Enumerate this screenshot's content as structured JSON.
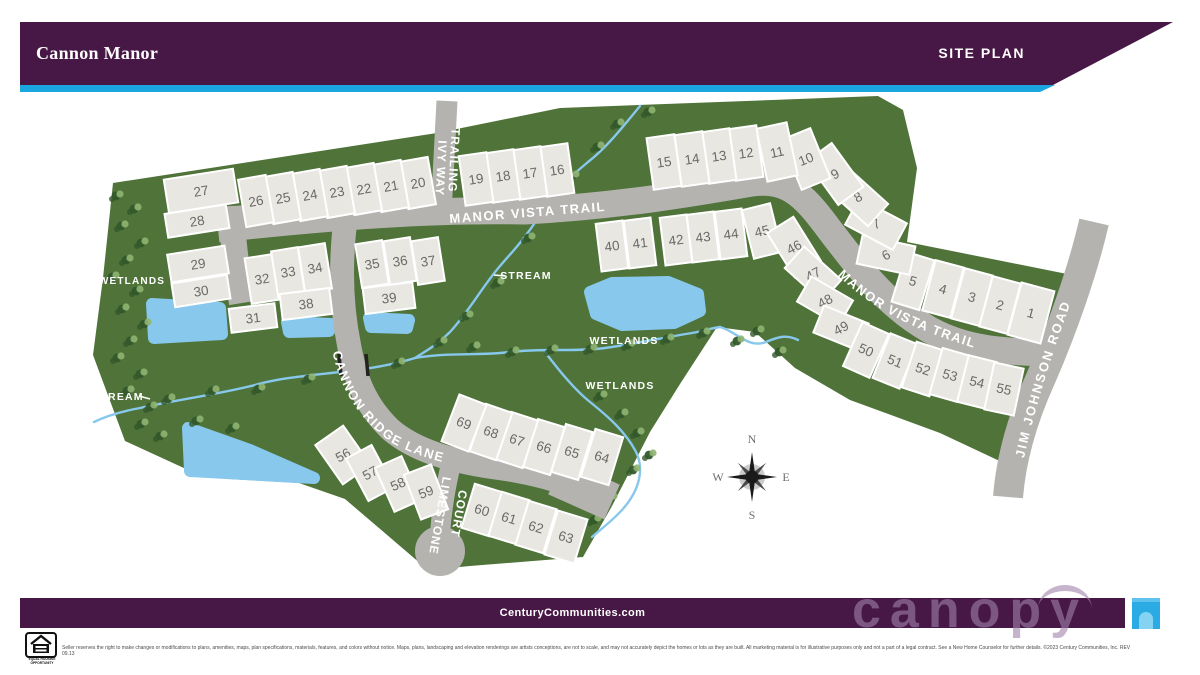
{
  "header": {
    "title": "Cannon Manor",
    "banner_label": "SITE PLAN"
  },
  "colors": {
    "brand_purple": "#471745",
    "accent_cyan": "#1aa7e0",
    "green": "#4f7339",
    "road": "#b5b3b0",
    "lot_fill": "#e9e7e2",
    "lot_stroke": "#ffffff",
    "lot_number": "#6b6a67",
    "water": "#87c8ec",
    "tree_dark": "#33582b",
    "tree_light": "#8fb471",
    "label_white": "#ffffff",
    "compass_dark": "#1a1a1a",
    "compass_gray": "#4a4a4a"
  },
  "map": {
    "site_points": "113,183 437,133 560,108 878,96 903,110 917,168 907,242 1082,277 1046,392 1006,464 940,433 850,400 795,368 755,332 717,327 680,384 650,432 612,506 583,557 470,566 428,570 345,499 299,483 230,479 186,469 125,441 93,355 103,278",
    "roads": [
      {
        "name": "manor-vista-trail",
        "d": "M218,229 C330,217 430,209 525,211 C620,206 700,192 752,183 C790,178 806,198 832,233 C862,272 888,306 930,330 C965,349 1000,352 1052,353",
        "w": 27
      },
      {
        "name": "access-stub",
        "d": "M231,206 C233,245 237,272 242,303",
        "w": 26
      },
      {
        "name": "trailing-ivy-way",
        "d": "M447,101 L441,214",
        "w": 21
      },
      {
        "name": "cannon-ridge-lane",
        "d": "M346,216 C340,260 341,305 349,345 C356,384 368,408 391,430 C416,451 452,461 492,467 C530,472 560,479 606,500",
        "w": 24
      },
      {
        "name": "cannon-ridge-lane-flare",
        "d": "M556,477 L612,502",
        "w": 38
      },
      {
        "name": "limestone-court",
        "d": "M452,460 C446,484 442,506 440,534",
        "w": 20
      },
      {
        "name": "jim-johnson-road",
        "d": "M1094,222 C1083,270 1062,330 1040,380 C1022,420 1011,460 1008,497",
        "w": 30
      }
    ],
    "cul_de_sac": {
      "cx": 440,
      "cy": 551,
      "r": 25
    },
    "culverts": [
      [
        339,
        354,
        341,
        376
      ],
      [
        366,
        354,
        368,
        376
      ]
    ],
    "streams": [
      "M640,106 C622,128 606,148 588,162 C566,180 552,196 540,215 C524,240 512,252 500,266 C482,287 470,310 450,332 C436,346 424,352 415,358",
      "M415,358 C360,375 300,372 255,385 C215,395 175,400 140,408 C118,412 104,417 94,422",
      "M415,358 C450,352 480,356 510,352 C545,348 575,352 605,348 C640,343 666,337 692,333 C704,331 712,328 720,327",
      "M720,327 C736,331 748,349 766,342 C778,337 786,334 798,340",
      "M545,352 C560,372 575,390 590,402 C610,418 625,432 635,450 C645,468 640,490 622,510 C612,521 601,529 592,537"
    ],
    "ponds": [
      {
        "pts": "152,304 220,308 222,334 154,338"
      },
      {
        "pts": "287,322 331,324 329,331 289,332"
      },
      {
        "pts": "369,318 409,320 407,328 371,327"
      },
      {
        "pts": "188,428 250,450 314,478 190,471"
      },
      {
        "pts": "590,292 612,283 668,282 698,294 700,311 674,323 622,325 596,314"
      }
    ],
    "trees": [
      [
        116,
        196
      ],
      [
        134,
        209
      ],
      [
        121,
        226
      ],
      [
        141,
        243
      ],
      [
        126,
        260
      ],
      [
        112,
        277
      ],
      [
        136,
        291
      ],
      [
        122,
        309
      ],
      [
        144,
        324
      ],
      [
        130,
        341
      ],
      [
        117,
        358
      ],
      [
        140,
        374
      ],
      [
        127,
        391
      ],
      [
        150,
        407
      ],
      [
        141,
        424
      ],
      [
        160,
        436
      ],
      [
        648,
        112
      ],
      [
        617,
        124
      ],
      [
        597,
        147
      ],
      [
        572,
        176
      ],
      [
        553,
        204
      ],
      [
        528,
        238
      ],
      [
        497,
        283
      ],
      [
        466,
        316
      ],
      [
        440,
        342
      ],
      [
        398,
        363
      ],
      [
        356,
        371
      ],
      [
        308,
        379
      ],
      [
        258,
        389
      ],
      [
        212,
        391
      ],
      [
        168,
        399
      ],
      [
        232,
        428
      ],
      [
        196,
        421
      ],
      [
        473,
        347
      ],
      [
        512,
        352
      ],
      [
        551,
        350
      ],
      [
        590,
        349
      ],
      [
        628,
        345
      ],
      [
        667,
        339
      ],
      [
        703,
        333
      ],
      [
        737,
        341
      ],
      [
        757,
        331
      ],
      [
        779,
        352
      ],
      [
        600,
        396
      ],
      [
        621,
        414
      ],
      [
        637,
        433
      ],
      [
        649,
        455
      ],
      [
        633,
        470
      ],
      [
        610,
        498
      ],
      [
        594,
        520
      ]
    ],
    "lots": [
      [
        1,
        1031,
        313,
        15,
        34,
        54
      ],
      [
        2,
        1000,
        305,
        15,
        29,
        52
      ],
      [
        3,
        972,
        297,
        15,
        29,
        52
      ],
      [
        4,
        943,
        289,
        15,
        29,
        52
      ],
      [
        5,
        913,
        281,
        17,
        29,
        52
      ],
      [
        6,
        886,
        255,
        -78,
        29,
        54
      ],
      [
        7,
        876,
        224,
        -62,
        30,
        54
      ],
      [
        8,
        858,
        197,
        -48,
        30,
        54
      ],
      [
        9,
        835,
        174,
        -36,
        31,
        54
      ],
      [
        10,
        806,
        159,
        -22,
        31,
        54
      ],
      [
        11,
        777,
        152,
        -12,
        31,
        54
      ],
      [
        12,
        746,
        153,
        -8,
        28,
        52
      ],
      [
        13,
        719,
        156,
        -8,
        28,
        52
      ],
      [
        14,
        692,
        159,
        -8,
        28,
        52
      ],
      [
        15,
        664,
        162,
        -8,
        28,
        52
      ],
      [
        16,
        557,
        170,
        -8,
        28,
        50
      ],
      [
        17,
        530,
        173,
        -8,
        28,
        50
      ],
      [
        18,
        503,
        176,
        -8,
        28,
        50
      ],
      [
        19,
        476,
        179,
        -8,
        28,
        50
      ],
      [
        20,
        418,
        183,
        -10,
        28,
        48
      ],
      [
        21,
        391,
        186,
        -10,
        28,
        48
      ],
      [
        22,
        364,
        189,
        -10,
        28,
        48
      ],
      [
        23,
        337,
        192,
        -10,
        28,
        48
      ],
      [
        24,
        310,
        195,
        -10,
        28,
        48
      ],
      [
        25,
        283,
        198,
        -10,
        28,
        48
      ],
      [
        26,
        256,
        201,
        -10,
        28,
        48
      ],
      [
        27,
        201,
        191,
        -9,
        70,
        34
      ],
      [
        28,
        197,
        221,
        -9,
        62,
        24
      ],
      [
        29,
        198,
        264,
        -9,
        58,
        28
      ],
      [
        30,
        201,
        291,
        -9,
        56,
        24
      ],
      [
        31,
        253,
        318,
        -7,
        46,
        24
      ],
      [
        32,
        262,
        279,
        -9,
        28,
        46
      ],
      [
        33,
        288,
        272,
        -9,
        27,
        46
      ],
      [
        34,
        315,
        268,
        -9,
        27,
        46
      ],
      [
        35,
        372,
        264,
        -9,
        27,
        44
      ],
      [
        36,
        400,
        261,
        -9,
        27,
        44
      ],
      [
        37,
        428,
        261,
        -9,
        27,
        44
      ],
      [
        38,
        306,
        304,
        -7,
        50,
        26
      ],
      [
        39,
        389,
        298,
        -7,
        50,
        26
      ],
      [
        40,
        612,
        246,
        -7,
        27,
        48
      ],
      [
        41,
        640,
        243,
        -7,
        27,
        48
      ],
      [
        42,
        676,
        240,
        -7,
        27,
        48
      ],
      [
        43,
        703,
        237,
        -7,
        27,
        48
      ],
      [
        44,
        731,
        234,
        -7,
        27,
        48
      ],
      [
        45,
        762,
        231,
        -14,
        29,
        50
      ],
      [
        46,
        794,
        247,
        -32,
        31,
        52
      ],
      [
        47,
        813,
        274,
        -48,
        29,
        50
      ],
      [
        48,
        825,
        301,
        -60,
        29,
        48
      ],
      [
        49,
        841,
        328,
        -68,
        29,
        48
      ],
      [
        50,
        866,
        350,
        24,
        29,
        48
      ],
      [
        51,
        895,
        361,
        22,
        29,
        48
      ],
      [
        52,
        923,
        369,
        18,
        29,
        48
      ],
      [
        53,
        950,
        375,
        16,
        29,
        48
      ],
      [
        54,
        977,
        382,
        14,
        29,
        48
      ],
      [
        55,
        1004,
        389,
        12,
        30,
        48
      ],
      [
        56,
        343,
        455,
        -35,
        34,
        48
      ],
      [
        57,
        370,
        473,
        -28,
        29,
        48
      ],
      [
        58,
        398,
        484,
        -24,
        29,
        48
      ],
      [
        59,
        426,
        492,
        -21,
        29,
        48
      ],
      [
        60,
        482,
        510,
        17,
        29,
        46
      ],
      [
        61,
        509,
        518,
        17,
        29,
        46
      ],
      [
        62,
        536,
        527,
        17,
        29,
        46
      ],
      [
        63,
        566,
        537,
        17,
        31,
        46
      ],
      [
        64,
        602,
        457,
        17,
        29,
        50
      ],
      [
        65,
        572,
        452,
        17,
        28,
        50
      ],
      [
        66,
        544,
        447,
        17,
        28,
        50
      ],
      [
        67,
        517,
        440,
        18,
        28,
        50
      ],
      [
        68,
        491,
        432,
        19,
        28,
        50
      ],
      [
        69,
        464,
        423,
        21,
        29,
        50
      ]
    ],
    "labels": [
      {
        "text": "WETLANDS",
        "x": 132,
        "y": 284,
        "s": 10
      },
      {
        "text": "WETLANDS",
        "x": 624,
        "y": 344,
        "s": 10.5
      },
      {
        "text": "WETLANDS",
        "x": 620,
        "y": 389,
        "s": 10.5
      },
      {
        "text": "STREAM",
        "x": 526,
        "y": 279,
        "s": 10.5
      },
      {
        "text": "STREAM",
        "x": 118,
        "y": 400,
        "s": 10.5
      }
    ],
    "label_dashes": [
      [
        494,
        275,
        505,
        276
      ],
      [
        139,
        396,
        150,
        399
      ]
    ],
    "street_labels_straight": [
      {
        "name": "manor-vista-trail-label-1",
        "text": "MANOR VISTA TRAIL",
        "x": 528,
        "y": 217,
        "r": -4.5,
        "s": 13,
        "ls": 1.5
      },
      {
        "name": "trailing-ivy-way-label-1",
        "text": "TRAILING",
        "x": 450,
        "y": 160,
        "r": 93,
        "s": 12,
        "ls": 1
      },
      {
        "name": "trailing-ivy-way-label-2",
        "text": "IVY WAY",
        "x": 437,
        "y": 168,
        "r": 93,
        "s": 12,
        "ls": 1
      },
      {
        "name": "limestone-court-label-1",
        "text": "LIMESTONE",
        "x": 436,
        "y": 515,
        "r": 100,
        "s": 12,
        "ls": 1
      },
      {
        "name": "limestone-court-label-2",
        "text": "COURT",
        "x": 455,
        "y": 513,
        "r": 100,
        "s": 12,
        "ls": 1
      }
    ],
    "street_labels_curved": [
      {
        "name": "manor-vista-trail-label-2",
        "text": "MANOR VISTA TRAIL",
        "d": "M836,274 C872,308 908,330 996,354",
        "off": 2,
        "s": 13,
        "ls": 1.5
      },
      {
        "name": "cannon-ridge-lane-label",
        "text": "CANNON RIDGE LANE",
        "d": "M332,350 C342,396 362,421 392,443 C430,463 466,468 510,472",
        "off": 2,
        "s": 13,
        "ls": 1.5
      },
      {
        "name": "jim-johnson-road-label",
        "text": "JIM JOHNSON ROAD",
        "d": "M1021,474 C1031,420 1048,366 1067,313 C1075,289 1083,258 1090,230",
        "off": 16,
        "s": 13,
        "ls": 2
      }
    ],
    "compass": {
      "cx": 752,
      "cy": 477,
      "n": "N",
      "e": "E",
      "s": "S",
      "w": "W"
    }
  },
  "footer": {
    "website": "CenturyCommunities.com",
    "watermark": "canopy",
    "eho_caption": "EQUAL HOUSING OPPORTUNITY",
    "disclaimer": "Seller reserves the right to make changes or modifications to plans, amenities, maps, plan specifications, materials, features, and colors without notice. Maps, plans, landscaping and elevation renderings are artists conceptions, are not to scale, and may not accurately depict the homes or lots as they are built. All marketing material is for illustrative purposes only and not a part of a legal contract. See a New Home Counselor for further details. ©2023 Century Communities, Inc. REV 09.13"
  }
}
